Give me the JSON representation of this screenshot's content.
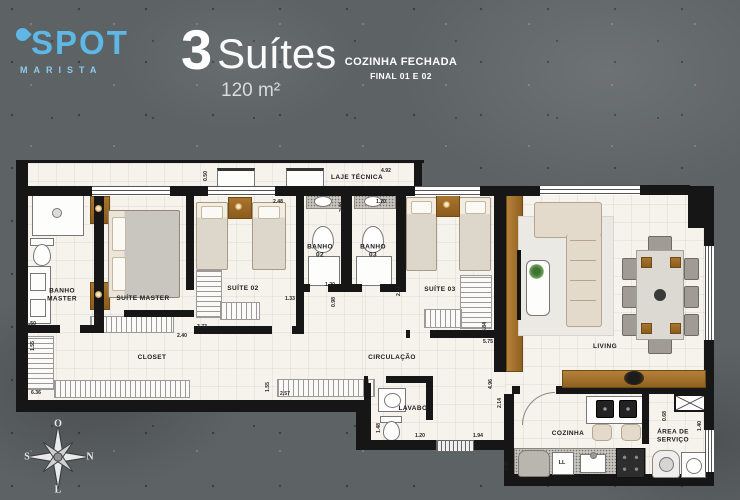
{
  "header": {
    "logo_name": "SPOT",
    "logo_subtitle": "MARISTA",
    "title_number": "3",
    "title_text": "Suítes",
    "area": "120 m²",
    "note_line1": "COZINHA FECHADA",
    "note_line2": "FINAL 01 E 02"
  },
  "compass": {
    "top": "O",
    "right": "N",
    "left": "S",
    "bottom": "L"
  },
  "plan": {
    "room_labels": [
      {
        "id": "laje-tecnica",
        "text": "LAJE TÉCNICA",
        "x": 357,
        "y": 178
      },
      {
        "id": "banho-master",
        "text": "BANHO\nMASTER",
        "x": 62,
        "y": 296
      },
      {
        "id": "suite-master",
        "text": "SUÍTE MASTER",
        "x": 143,
        "y": 299
      },
      {
        "id": "suite-02",
        "text": "SUÍTE 02",
        "x": 243,
        "y": 289
      },
      {
        "id": "banho-02",
        "text": "BANHO\n02",
        "x": 320,
        "y": 252
      },
      {
        "id": "banho-03",
        "text": "BANHO\n03",
        "x": 373,
        "y": 252
      },
      {
        "id": "suite-03",
        "text": "SUÍTE 03",
        "x": 440,
        "y": 290
      },
      {
        "id": "closet",
        "text": "CLOSET",
        "x": 152,
        "y": 358
      },
      {
        "id": "circulacao",
        "text": "CIRCULAÇÃO",
        "x": 392,
        "y": 358
      },
      {
        "id": "lavabo",
        "text": "LAVABO",
        "x": 413,
        "y": 409
      },
      {
        "id": "living",
        "text": "LIVING",
        "x": 605,
        "y": 347
      },
      {
        "id": "cozinha",
        "text": "COZINHA",
        "x": 568,
        "y": 434
      },
      {
        "id": "area-de-servico",
        "text": "ÁREA DE\nSERVIÇO",
        "x": 673,
        "y": 437
      }
    ],
    "dimensions": [
      {
        "text": "0.50",
        "x": 206,
        "y": 176,
        "vertical": true
      },
      {
        "text": "4.92",
        "x": 386,
        "y": 171,
        "vertical": false
      },
      {
        "text": "2.48",
        "x": 278,
        "y": 202,
        "vertical": false
      },
      {
        "text": "1.20",
        "x": 381,
        "y": 202,
        "vertical": false
      },
      {
        "text": "2.40",
        "x": 342,
        "y": 207,
        "vertical": true
      },
      {
        "text": "1.20",
        "x": 330,
        "y": 285,
        "vertical": false
      },
      {
        "text": "1.33",
        "x": 290,
        "y": 299,
        "vertical": false
      },
      {
        "text": "0.98",
        "x": 334,
        "y": 302,
        "vertical": true
      },
      {
        "text": "2.51",
        "x": 399,
        "y": 291,
        "vertical": true
      },
      {
        "text": "3.84",
        "x": 485,
        "y": 327,
        "vertical": true
      },
      {
        "text": "3.73",
        "x": 202,
        "y": 327,
        "vertical": false
      },
      {
        "text": "1.50",
        "x": 31,
        "y": 324,
        "vertical": false
      },
      {
        "text": "3.51",
        "x": 97,
        "y": 318,
        "vertical": true
      },
      {
        "text": "2.40",
        "x": 182,
        "y": 336,
        "vertical": false
      },
      {
        "text": "1.55",
        "x": 33,
        "y": 346,
        "vertical": true
      },
      {
        "text": "6.36",
        "x": 36,
        "y": 393,
        "vertical": false
      },
      {
        "text": "1.55",
        "x": 268,
        "y": 387,
        "vertical": true
      },
      {
        "text": "2.57",
        "x": 285,
        "y": 394,
        "vertical": false
      },
      {
        "text": "5.75",
        "x": 488,
        "y": 342,
        "vertical": false
      },
      {
        "text": "4.96",
        "x": 491,
        "y": 384,
        "vertical": true
      },
      {
        "text": "1.48",
        "x": 379,
        "y": 428,
        "vertical": true
      },
      {
        "text": "1.20",
        "x": 420,
        "y": 436,
        "vertical": false
      },
      {
        "text": "1.94",
        "x": 478,
        "y": 436,
        "vertical": false
      },
      {
        "text": "2.14",
        "x": 500,
        "y": 403,
        "vertical": true
      },
      {
        "text": "3.40",
        "x": 507,
        "y": 466,
        "vertical": true
      },
      {
        "text": "0.68",
        "x": 665,
        "y": 416,
        "vertical": true
      },
      {
        "text": "1.40",
        "x": 700,
        "y": 426,
        "vertical": true
      }
    ],
    "fixture_labels": [
      {
        "id": "dishwasher",
        "text": "LL",
        "x": 562,
        "y": 463
      }
    ]
  },
  "colors": {
    "logo_blue": "#5fb7e6",
    "wall_black": "#161616",
    "floor_white": "#f6f3ed",
    "wood_brown": "#a9742e",
    "concrete_gray": "#5d6264"
  }
}
